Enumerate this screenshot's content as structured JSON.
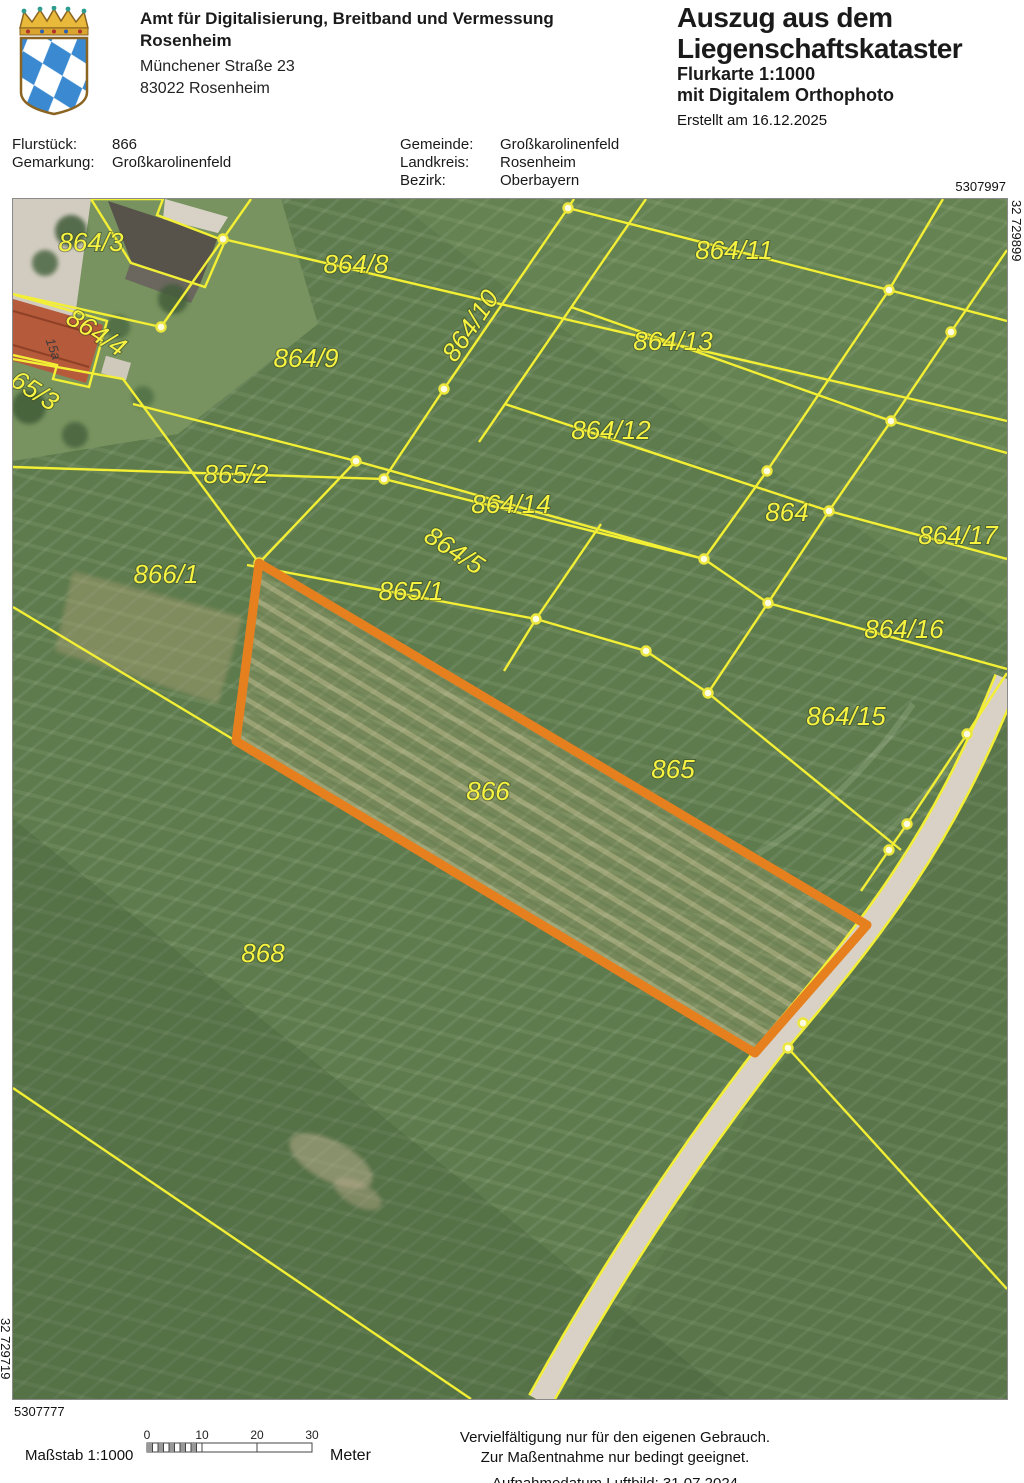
{
  "header": {
    "agency_name_line1": "Amt für Digitalisierung, Breitband und Vermessung",
    "agency_name_line2": "Rosenheim",
    "address_line1": "Münchener Straße 23",
    "address_line2": "83022 Rosenheim",
    "title_line1": "Auszug aus dem",
    "title_line2": "Liegenschaftskataster",
    "subtitle_line1": "Flurkarte 1:1000",
    "subtitle_line2": "mit Digitalem Orthophoto",
    "created": "Erstellt am 16.12.2025"
  },
  "meta": {
    "flurstueck_label": "Flurstück:",
    "flurstueck_value": "866",
    "gemarkung_label": "Gemarkung:",
    "gemarkung_value": "Großkarolinenfeld",
    "gemeinde_label": "Gemeinde:",
    "gemeinde_value": "Großkarolinenfeld",
    "landkreis_label": "Landkreis:",
    "landkreis_value": "Rosenheim",
    "bezirk_label": "Bezirk:",
    "bezirk_value": "Oberbayern"
  },
  "map": {
    "corner_coords": {
      "top_right_northing": "5307997",
      "bottom_left_northing": "5307777",
      "right_easting": "32 729899",
      "left_easting": "32 729719"
    },
    "highlighted_parcel": "866",
    "highlight_color": "#e6801e",
    "parcel_line_color": "#f3ef35",
    "house_number": "15a",
    "parcels": [
      {
        "label": "864/3"
      },
      {
        "label": "864/8"
      },
      {
        "label": "864/11"
      },
      {
        "label": "864/4"
      },
      {
        "label": "864/10"
      },
      {
        "label": "864/13"
      },
      {
        "label": "864/9"
      },
      {
        "label": "65/3"
      },
      {
        "label": "864/12"
      },
      {
        "label": "865/2"
      },
      {
        "label": "864/14"
      },
      {
        "label": "864"
      },
      {
        "label": "864/17"
      },
      {
        "label": "864/5"
      },
      {
        "label": "866/1"
      },
      {
        "label": "865/1"
      },
      {
        "label": "864/16"
      },
      {
        "label": "864/15"
      },
      {
        "label": "865"
      },
      {
        "label": "866"
      },
      {
        "label": "868"
      }
    ]
  },
  "footer": {
    "scale_label": "Maßstab 1:1000",
    "scale_ticks": [
      "0",
      "10",
      "20",
      "30"
    ],
    "scale_unit": "Meter",
    "notice_line1": "Vervielfältigung nur für den eigenen Gebrauch.",
    "notice_line2": "Zur Maßentnahme nur bedingt geeignet.",
    "notice_line3": "Aufnahmedatum Luftbild: 31.07.2024"
  }
}
